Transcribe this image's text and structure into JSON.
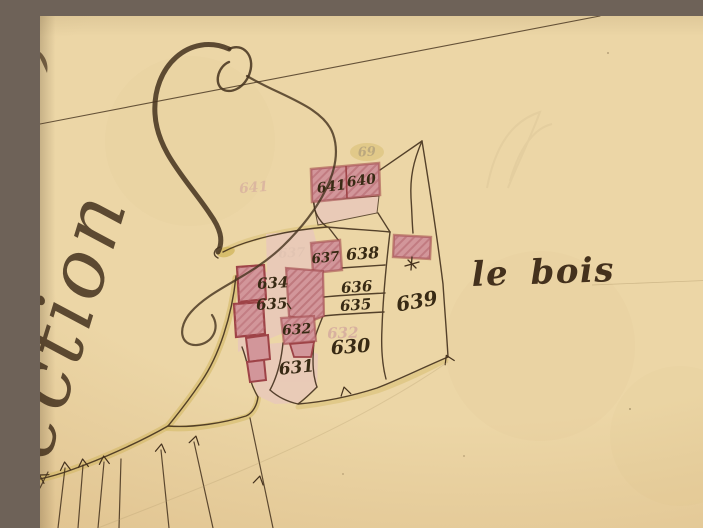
{
  "map": {
    "kind": "antique cadastral plan (scanned sheet)",
    "region_word": "Section",
    "region_word_visible": "ection",
    "place_name": "le bois",
    "building_labels": {
      "b641": "641",
      "b640": "640",
      "b637": "637",
      "b632": "632"
    },
    "parcel_labels": {
      "p638": "638",
      "p636": "636",
      "p635_right": "635",
      "p634": "634",
      "p635_left": "635",
      "p630": "630",
      "p631": "631",
      "p639": "639"
    },
    "ghost_labels": {
      "g641": "641",
      "g637": "637",
      "g632": "632",
      "g69": "69"
    }
  },
  "colors": {
    "paper": "#ecd6a6",
    "paper_shade": "#ddbe8a",
    "ink": "#44311d",
    "label_ink": "#382a14",
    "building_border": "#9e4347",
    "building_fill": "#d2969a",
    "building_hatch": "#b4666d",
    "courtyard_wash": "#e9c8bc",
    "road_wash": "#d2b75e",
    "ghost_pink": "#d4a89e",
    "ghost_gray": "#a39378",
    "crease": "#b49b6e"
  }
}
